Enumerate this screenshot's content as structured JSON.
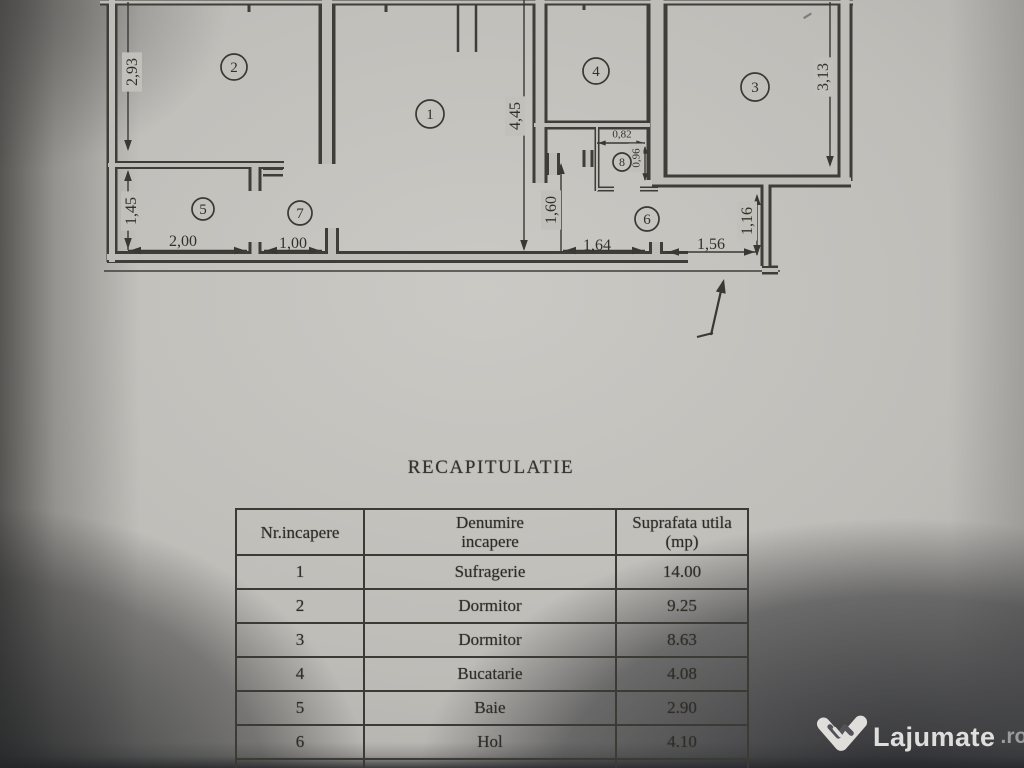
{
  "plan": {
    "room_labels": [
      {
        "num": "1",
        "x": 430,
        "y": 114,
        "r": 14
      },
      {
        "num": "2",
        "x": 234,
        "y": 67,
        "r": 13
      },
      {
        "num": "3",
        "x": 755,
        "y": 87,
        "r": 14
      },
      {
        "num": "4",
        "x": 596,
        "y": 71,
        "r": 13
      },
      {
        "num": "5",
        "x": 203,
        "y": 209,
        "r": 11
      },
      {
        "num": "6",
        "x": 647,
        "y": 219,
        "r": 12
      },
      {
        "num": "7",
        "x": 300,
        "y": 213,
        "r": 12
      },
      {
        "num": "8",
        "x": 622,
        "y": 162,
        "r": 9
      }
    ],
    "dimensions": [
      {
        "text": "2,93",
        "x": 132,
        "y": 72,
        "rotated": true
      },
      {
        "text": "1,45",
        "x": 131,
        "y": 211,
        "rotated": true
      },
      {
        "text": "2,00",
        "x": 183,
        "y": 241
      },
      {
        "text": "1,00",
        "x": 293,
        "y": 243
      },
      {
        "text": "4,45",
        "x": 515,
        "y": 116,
        "rotated": true
      },
      {
        "text": "1,60",
        "x": 551,
        "y": 210,
        "rotated": true
      },
      {
        "text": "1,64",
        "x": 597,
        "y": 245
      },
      {
        "text": "1,56",
        "x": 711,
        "y": 244
      },
      {
        "text": "1,16",
        "x": 747,
        "y": 221,
        "rotated": true
      },
      {
        "text": "0,82",
        "x": 622,
        "y": 134,
        "small": true
      },
      {
        "text": "0,96",
        "x": 636,
        "y": 158,
        "rotated": true,
        "small": true
      },
      {
        "text": "3,13",
        "x": 823,
        "y": 77,
        "rotated": true
      }
    ]
  },
  "summary": {
    "title": "RECAPITULATIE",
    "columns": [
      {
        "l1": "Nr.incapere",
        "l2": ""
      },
      {
        "l1": "Denumire",
        "l2": "incapere"
      },
      {
        "l1": "Suprafata utila",
        "l2": "(mp)"
      }
    ],
    "rows": [
      {
        "nr": "1",
        "name": "Sufragerie",
        "area": "14.00"
      },
      {
        "nr": "2",
        "name": "Dormitor",
        "area": "9.25"
      },
      {
        "nr": "3",
        "name": "Dormitor",
        "area": "8.63"
      },
      {
        "nr": "4",
        "name": "Bucatarie",
        "area": "4.08"
      },
      {
        "nr": "5",
        "name": "Baie",
        "area": "2.90"
      },
      {
        "nr": "6",
        "name": "Hol",
        "area": "4.10"
      },
      {
        "nr": "7",
        "name": "Hol",
        "area": "1.42"
      }
    ]
  },
  "watermark": {
    "brand": "Lajumate",
    "tld": ".ro",
    "icon": "lajumate-heart-icon"
  }
}
